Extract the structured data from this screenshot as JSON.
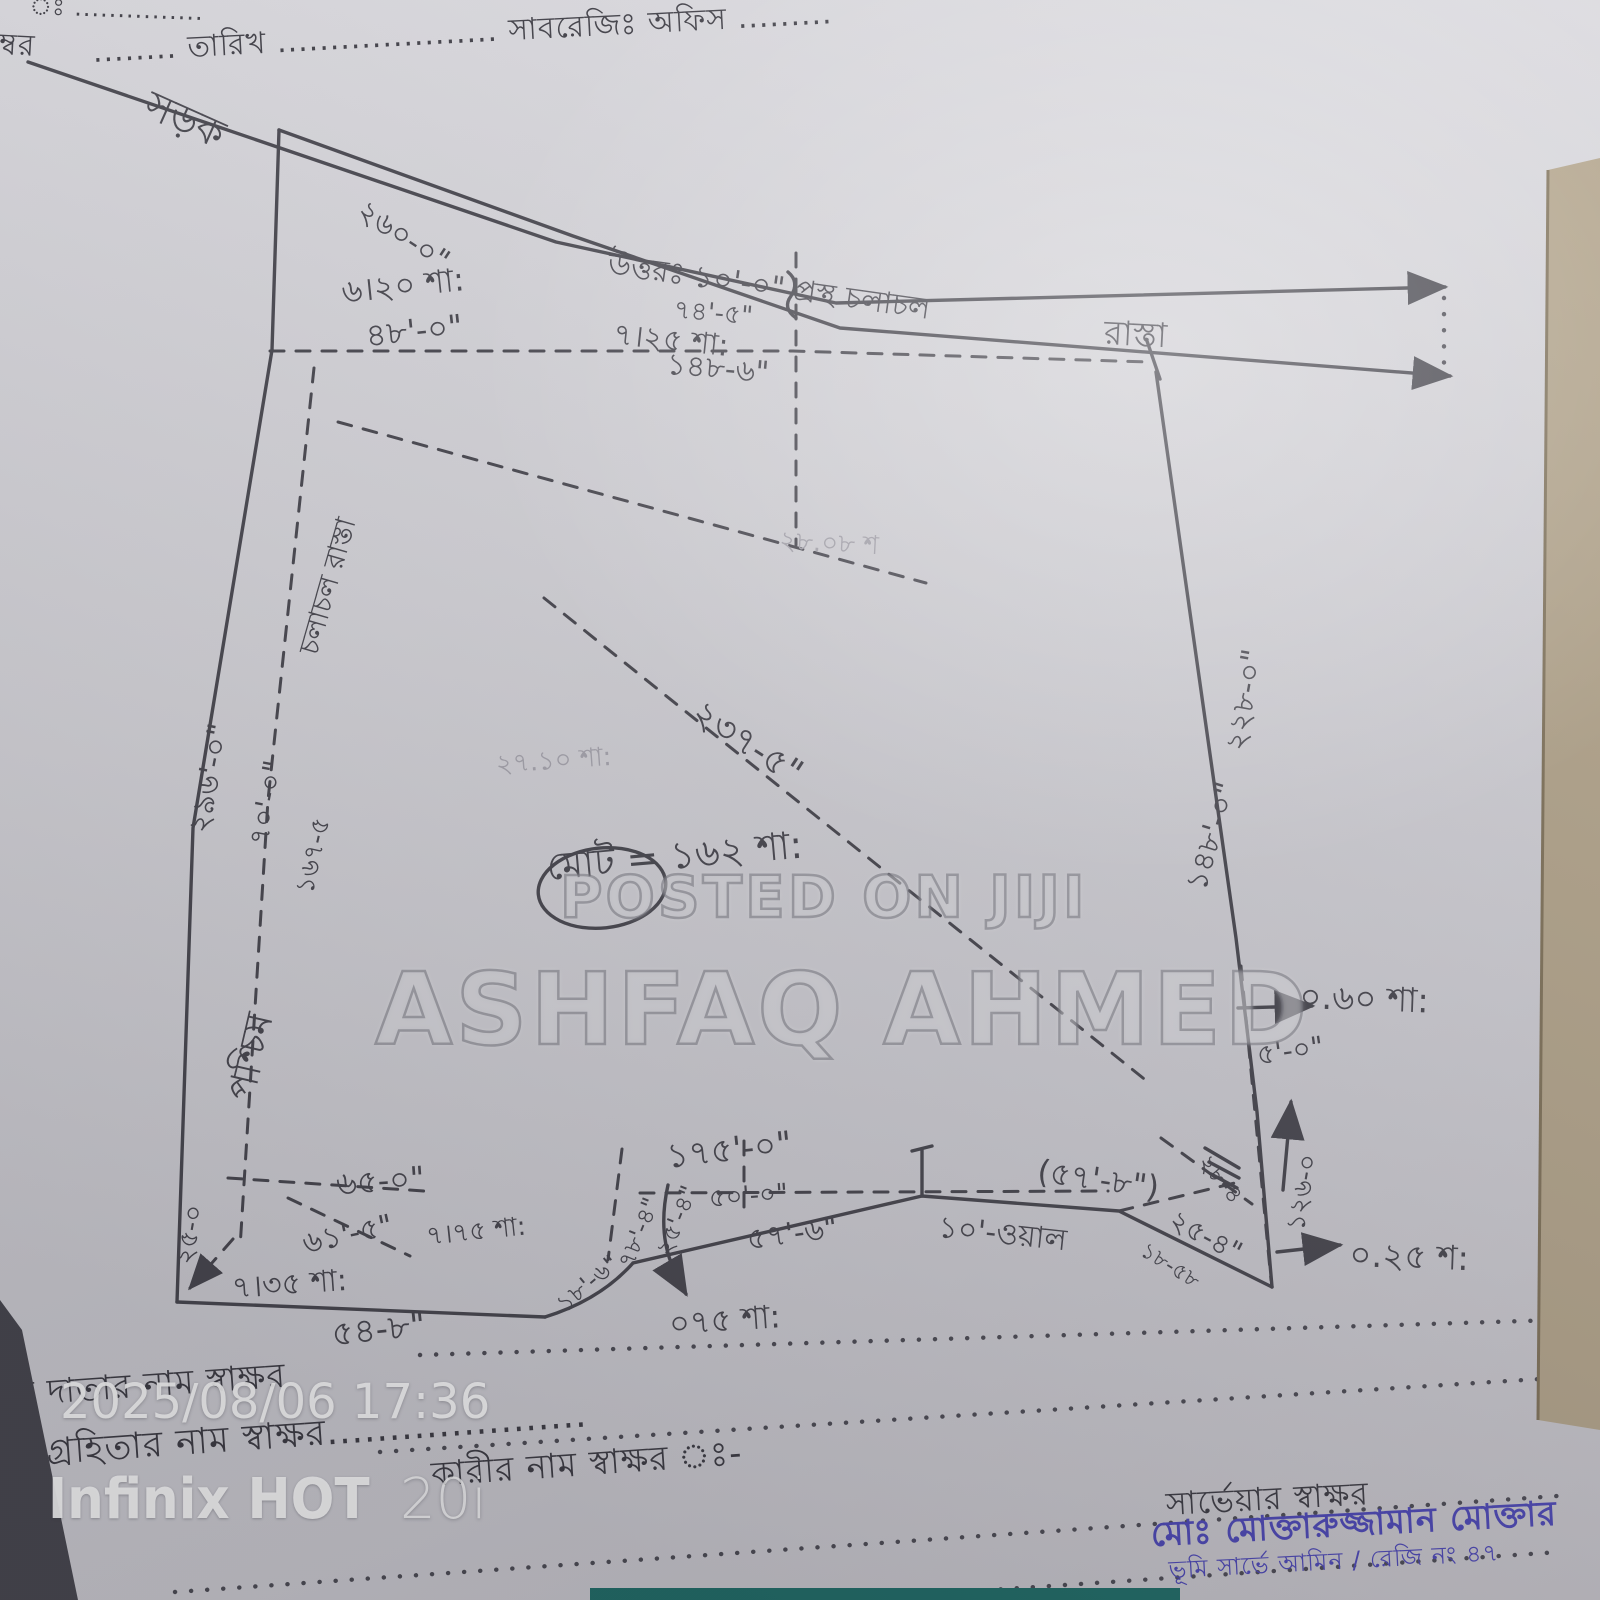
{
  "form": {
    "top_left_caption": "ঃ ...............",
    "top_left_word": "ম্বর",
    "date_line": "........ তারিখ ..................... সাবরেজিঃ অফিস .........",
    "line_donor": "ল দাতার নাম স্বাক্ষর",
    "line_recipient": "ল গ্রহিতার নাম স্বাক্ষর.....................",
    "line_sthita": "স্থিত",
    "line_identifier": "কারীর নাম স্বাক্ষর ঃ-",
    "surveyor_label": "সার্ভেয়ার স্বাক্ষর",
    "surveyor_name": "মোঃ মোক্তারুজ্জামান মোক্তার",
    "surveyor_reg": "ভূমি সার্ভে আমিন / রেজি নং ৪৭"
  },
  "watermarks": {
    "jiji_line1": "POSTED ON JIJI",
    "jiji_line2": "ASHFAQ AHMED",
    "timestamp": "2025/08/06 17:36",
    "device_brand": "Infinix HOT",
    "device_model": "20i"
  },
  "sketch": {
    "colors": {
      "pencil": "#45444c",
      "stamp_blue": "#4a45b5",
      "paper": "#d6d5da"
    },
    "labels": [
      "সড়ক",
      "২৬০-০\"",
      "৬।২০ শা:",
      "৪৮'-০\"",
      "উত্তরঃ ১০'-০\" প্রস্থ চলাচল",
      "রাস্তা",
      "৭৪'-৫\"",
      "৭।২৫ শা:",
      "১৪৮-৬\"",
      "২৯৬'-০\"",
      "৭০'-০\"",
      "১৬৭-৫",
      "পশ্চিম",
      "চলাচল রাস্তা",
      "২৩৭-৫\"",
      "২৭.১০ শা:",
      "মোট = ১৬২ শা:",
      "২২৮-০\"",
      "১৪৮'-০\"",
      "০.৬০ শা:",
      "৫'-০\"",
      "১২৬-০",
      "০.২৫ শ:",
      "(৫৭'-৮\")",
      "১০'-ওয়াল",
      "২৫-৪\"",
      "২৮-৪",
      "১৮-৫৮",
      "১৭৫'-০\"",
      "৫০'-০\"",
      "৫৭'-৬\"",
      "০৭৫ শা:",
      "২৫'-৪\"",
      "৭৮'-৪\"",
      "১৮'-৬\"",
      "৬৫-০\"",
      "৬১'-৫\"",
      "৭।৭৫ শা:",
      "৭।৩৫ শা:",
      "৫৪-৮\"",
      "২৫-০",
      "২৮.০৮ শ"
    ]
  }
}
